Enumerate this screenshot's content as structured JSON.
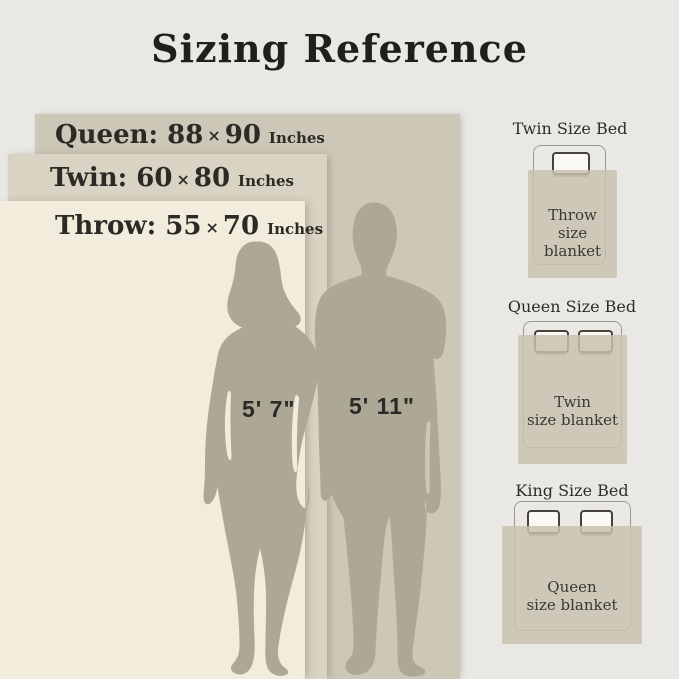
{
  "title": "Sizing Reference",
  "size_bands": [
    {
      "name": "Queen:",
      "width": "88",
      "times": "×",
      "height": "90",
      "unit": "Inches"
    },
    {
      "name": "Twin:",
      "width": "60",
      "times": "×",
      "height": "80",
      "unit": "Inches"
    },
    {
      "name": "Throw:",
      "width": "55",
      "times": "×",
      "height": "70",
      "unit": "Inches"
    }
  ],
  "figures": [
    {
      "name": "woman",
      "height": "5' 7\""
    },
    {
      "name": "man",
      "height": "5' 11\""
    }
  ],
  "beds": [
    {
      "title": "Twin Size Bed",
      "blanket_line1": "Throw",
      "blanket_line2": "size blanket"
    },
    {
      "title": "Queen Size Bed",
      "blanket_line1": "Twin",
      "blanket_line2": "size blanket"
    },
    {
      "title": "King Size Bed",
      "blanket_line1": "Queen",
      "blanket_line2": "size blanket"
    }
  ],
  "colors": {
    "background": "#e9e8e5",
    "queen_band": "#cdc7b8",
    "twin_band": "#d9d3c3",
    "throw_band": "#f2ecdc",
    "silhouette": "#ada896",
    "blanket_fill": "#cfc9ba",
    "text_dark": "#22211e"
  }
}
